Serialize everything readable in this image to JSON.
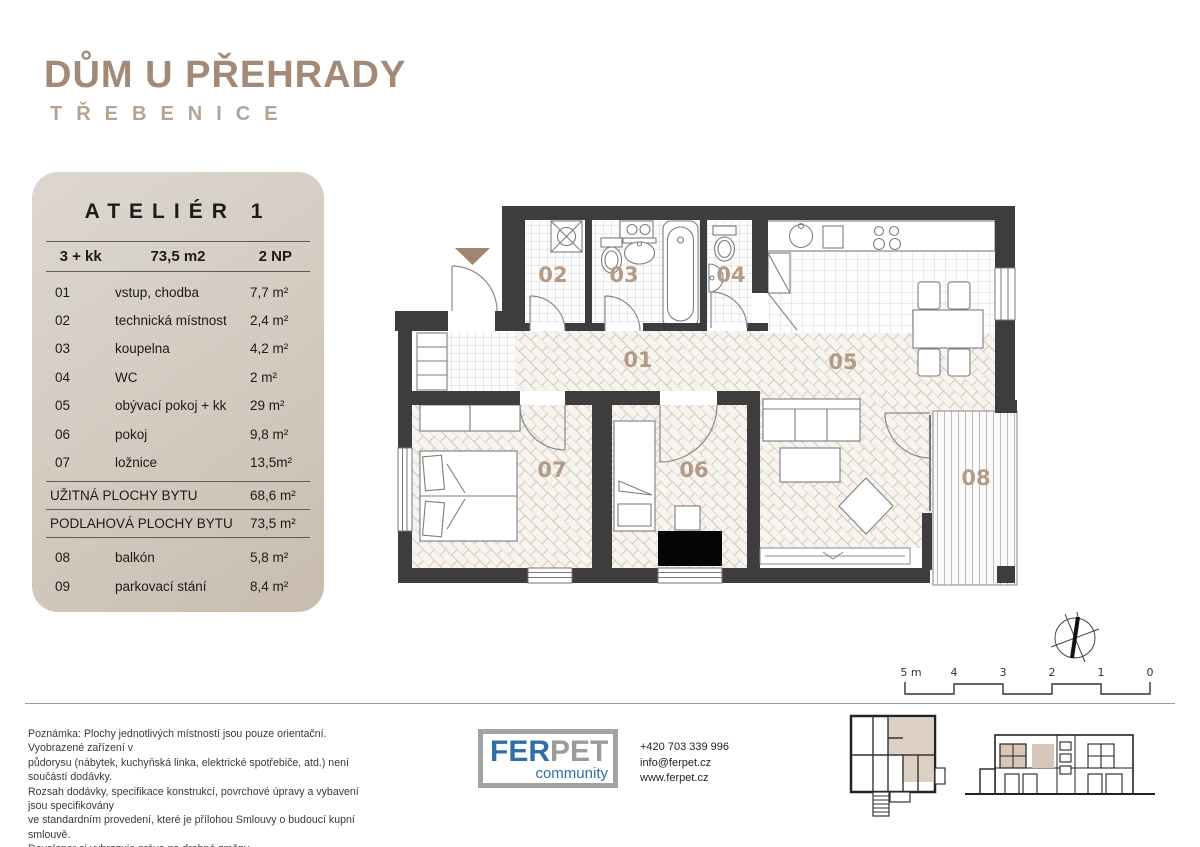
{
  "header": {
    "title": "DŮM U PŘEHRADY",
    "subtitle": "TŘEBENICE"
  },
  "panel": {
    "title": "ATELIÉR 1",
    "spec": {
      "layout": "3 + kk",
      "area": "73,5 m2",
      "floor": "2 NP"
    },
    "rooms": [
      {
        "num": "01",
        "name": "vstup, chodba",
        "area": "7,7 m²"
      },
      {
        "num": "02",
        "name": "technická místnost",
        "area": "2,4 m²"
      },
      {
        "num": "03",
        "name": "koupelna",
        "area": "4,2 m²"
      },
      {
        "num": "04",
        "name": "WC",
        "area": "2 m²"
      },
      {
        "num": "05",
        "name": "obývací pokoj + kk",
        "area": "29 m²"
      },
      {
        "num": "06",
        "name": "pokoj",
        "area": "9,8 m²"
      },
      {
        "num": "07",
        "name": "ložnice",
        "area": "13,5m²"
      }
    ],
    "summary": [
      {
        "label": "UŽITNÁ PLOCHY BYTU",
        "value": "68,6 m²"
      },
      {
        "label": "PODLAHOVÁ PLOCHY BYTU",
        "value": "73,5 m²"
      }
    ],
    "extras": [
      {
        "num": "08",
        "name": "balkón",
        "area": "5,8 m²"
      },
      {
        "num": "09",
        "name": "parkovací stání",
        "area": "8,4 m²"
      }
    ]
  },
  "plan": {
    "room_labels": {
      "r01": "01",
      "r02": "02",
      "r03": "03",
      "r04": "04",
      "r05": "05",
      "r06": "06",
      "r07": "07",
      "r08": "08"
    }
  },
  "scalebar": {
    "labels": [
      "5 m",
      "4",
      "3",
      "2",
      "1",
      "0"
    ]
  },
  "footer": {
    "note": "Poznámka: Plochy jednotlivých místností jsou pouze orientační. Vyobrazené zařízení v\npůdorysu (nábytek, kuchyňská linka, elektrické spotřebiče, atd.) není součástí dodávky.\nRozsah dodávky, specifikace konstrukcí, povrchové úpravy a vybavení jsou specifikovány\nve standardním provedení, které je přílohou Smlouvy  o budoucí kupní smlouvě.\nDeveloper si vyhrazuje právo na drobné změny.",
    "logo": {
      "part1": "FER",
      "part2": "PET",
      "tagline": "community"
    },
    "contact": {
      "phone": "+420 703 339 996",
      "email": "info@ferpet.cz",
      "web": "www.ferpet.cz"
    }
  },
  "colors": {
    "brand_taupe": "#a38a78",
    "wall_dark": "#3d3d3d",
    "logo_blue": "#2f6fa8",
    "logo_gray": "#9b9b9b",
    "panel_bg": "#d7d0c8",
    "highlight_tan": "#d8c7b8"
  }
}
